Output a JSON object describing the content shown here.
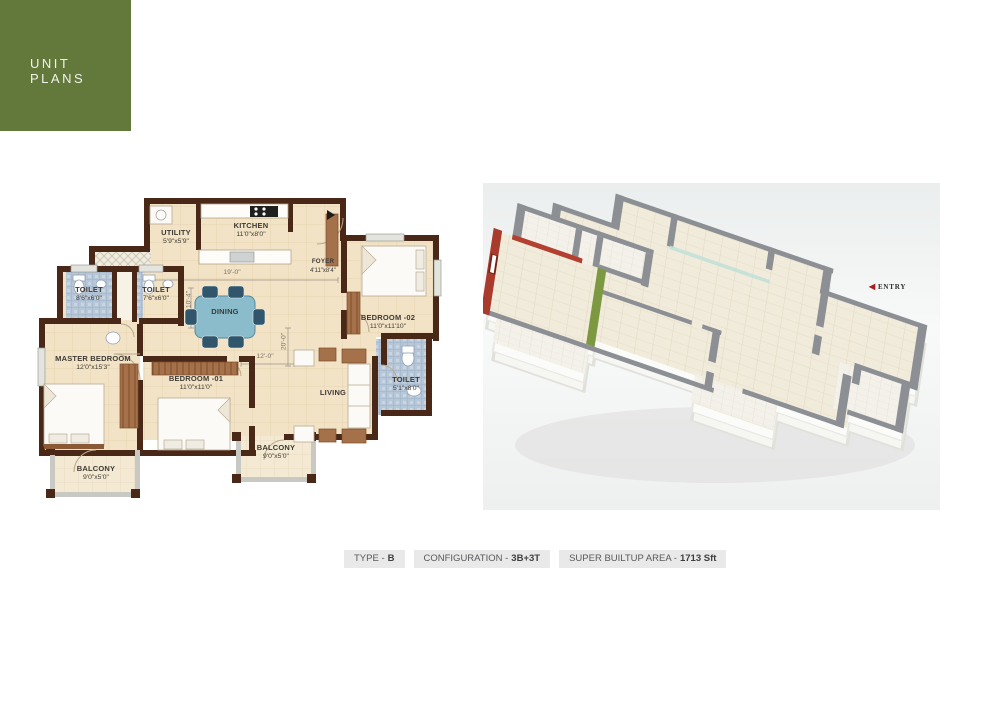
{
  "header": {
    "title": "UNIT PLANS"
  },
  "floor_plan": {
    "rooms": [
      {
        "id": "utility",
        "name": "UTILITY",
        "size": "5'9\"x5'9\""
      },
      {
        "id": "kitchen",
        "name": "KITCHEN",
        "size": "11'0\"x8'0\""
      },
      {
        "id": "foyer",
        "name": "FOYER",
        "size": "4'11\"x8'4\""
      },
      {
        "id": "toilet-1",
        "name": "TOILET",
        "size": "8'6\"x6'0\""
      },
      {
        "id": "toilet-2",
        "name": "TOILET",
        "size": "7'6\"x6'0\""
      },
      {
        "id": "dining",
        "name": "DINING",
        "size": ""
      },
      {
        "id": "bedroom-02",
        "name": "BEDROOM -02",
        "size": "11'0\"x11'10\""
      },
      {
        "id": "master-bedroom",
        "name": "MASTER BEDROOM",
        "size": "12'0\"x15'3\""
      },
      {
        "id": "bedroom-01",
        "name": "BEDROOM -01",
        "size": "11'0\"x11'0\""
      },
      {
        "id": "living",
        "name": "LIVING",
        "size": ""
      },
      {
        "id": "toilet-3",
        "name": "TOILET",
        "size": "5'1\"x8'0\""
      },
      {
        "id": "balcony-1",
        "name": "BALCONY",
        "size": "9'0\"x5'0\""
      },
      {
        "id": "balcony-2",
        "name": "BALCONY",
        "size": "9'0\"x5'0\""
      }
    ],
    "dimensions": {
      "top_width": "19'-0\"",
      "left_height": "10'-4\"",
      "living_width": "12'-0\"",
      "living_height": "20'-0\""
    }
  },
  "render_3d": {
    "entry_label": "ENTRY"
  },
  "footer": {
    "badges": [
      {
        "label": "TYPE -",
        "value": "B"
      },
      {
        "label": "CONFIGURATION -",
        "value": "3B+3T"
      },
      {
        "label": "SUPER BUILTUP AREA -",
        "value": "1713 Sft"
      }
    ]
  },
  "colors": {
    "header_green": "#62793b",
    "wall_brown": "#4a2817",
    "accent_red": "#a83b2b",
    "accent_green": "#7c9840",
    "entry_arrow_red": "#a91d20",
    "badge_gray": "#e9e9e9"
  }
}
